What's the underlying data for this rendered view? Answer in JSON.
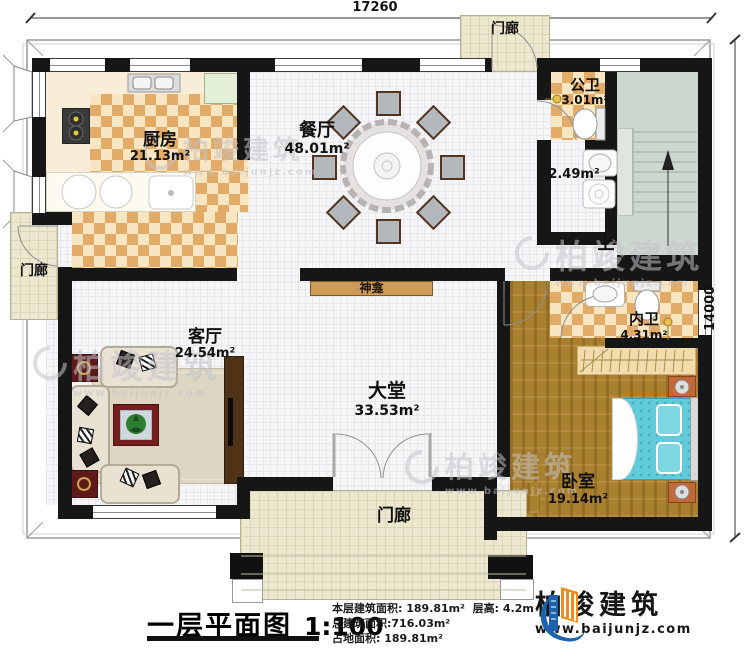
{
  "plan": {
    "dimensions": {
      "width_top": "17260",
      "height_right": "14000"
    },
    "rooms": {
      "kitchen": {
        "name": "厨房",
        "area": "21.13m²"
      },
      "dining": {
        "name": "餐厅",
        "area": "48.01m²"
      },
      "public_wc": {
        "name": "公卫",
        "area": "3.01m²"
      },
      "laundry": {
        "area": "2.49m²"
      },
      "living": {
        "name": "客厅",
        "area": "24.54m²"
      },
      "hall": {
        "name": "大堂",
        "area": "33.53m²"
      },
      "bedroom": {
        "name": "卧室",
        "area": "19.14m²"
      },
      "ensuite": {
        "name": "内卫",
        "area": "4.31m²"
      }
    },
    "porch_top": "门廊",
    "porch_left": "门廊",
    "porch_bottom": "门廊",
    "stairs_up": "上",
    "shrine": "神龛"
  },
  "titlebar": {
    "title": "一层平面图",
    "scale": "1:100"
  },
  "info": {
    "line1a": "本层建筑面积: 189.81m²",
    "line1b": "层高: 4.2m",
    "line2": "总建筑面积:716.03m²",
    "line3": "占地面积: 189.81m²"
  },
  "logo": {
    "name": "柏竣建筑",
    "website": "www.baijunjz.com"
  },
  "watermark": {
    "name": "柏竣建筑",
    "website": "www.baijunjz.com"
  },
  "colors": {
    "wall": "#161616",
    "checker": "#e3ab68",
    "wood": "#a8802f",
    "bed": "#62cbd9",
    "porch": "#ece7cf",
    "logo_blue": "#1c63ad",
    "logo_orange": "#f08c1e"
  }
}
